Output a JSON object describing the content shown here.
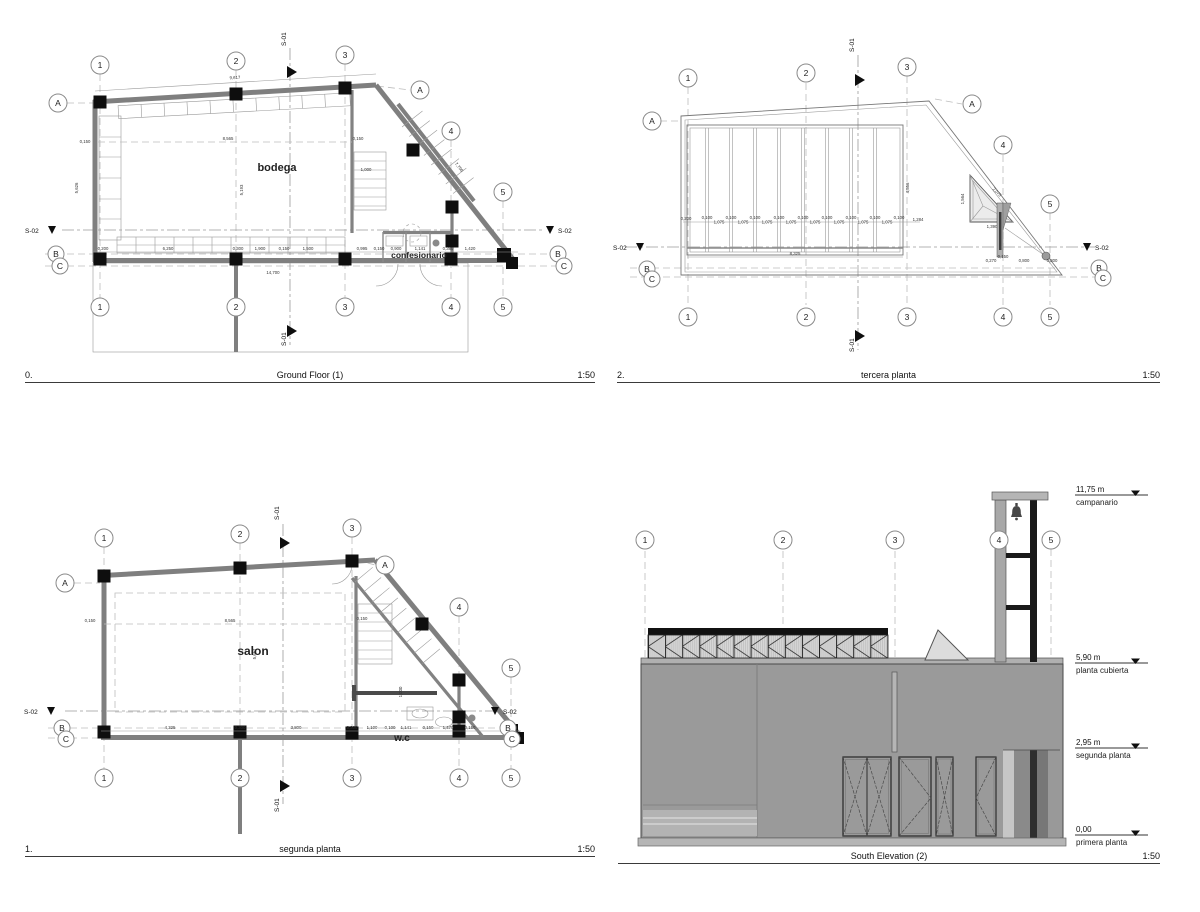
{
  "colors": {
    "wall": "#7f7f7f",
    "column": "#0e0e0e",
    "mass": "#9a9a9a",
    "mass_light": "#b5b5b5"
  },
  "panels": {
    "ground_floor": {
      "number": "0.",
      "title": "Ground Floor (1)",
      "scale": "1:50",
      "grid_cols": [
        "1",
        "2",
        "3",
        "4",
        "5"
      ],
      "grid_rows": {
        "a": "A",
        "b": "B",
        "c": "C"
      },
      "sections": {
        "s01": "S-01",
        "s02": "S-02"
      },
      "rooms": {
        "bodega": "bodega",
        "confesionario": "confesionario"
      },
      "dims": {
        "top_total": "9,617",
        "left_wall": "0,150",
        "left_height": "5,626",
        "mid_width": "8,565",
        "mid_height": "5,193",
        "mid_wall": "0,150",
        "diag": "7,796",
        "stair": "1,000",
        "bottom": [
          "0,200",
          "6,250",
          "0,300",
          "1,900",
          "0,150",
          "1,500",
          "0,995",
          "0,150",
          "0,900",
          "1,141",
          "0,380",
          "1,420"
        ],
        "bottom_total": "14,700"
      }
    },
    "tercera": {
      "number": "2.",
      "title": "tercera planta",
      "scale": "1:50",
      "grid_cols": [
        "1",
        "2",
        "3",
        "4",
        "5"
      ],
      "grid_rows": {
        "a": "A",
        "b": "B",
        "c": "C"
      },
      "sections": {
        "s01": "S-01",
        "s02": "S-02"
      },
      "dims": {
        "edge": "0,200",
        "joist": "0,100",
        "bay": "1,075",
        "right": "1,284",
        "total": "8,325",
        "height": "4,556",
        "tri_left": "1,564",
        "tri_hyp": "2,075",
        "tri_base": "1,390",
        "tower": [
          "0,270",
          "0,150",
          "0,800",
          "0,300"
        ]
      }
    },
    "segunda": {
      "number": "1.",
      "title": "segunda planta",
      "scale": "1:50",
      "grid_cols": [
        "1",
        "2",
        "3",
        "4",
        "5"
      ],
      "grid_rows": {
        "a": "A",
        "b": "B",
        "c": "C"
      },
      "sections": {
        "s01": "S-01",
        "s02": "S-02"
      },
      "rooms": {
        "salon": "salon",
        "wc": "w.c"
      },
      "dims": {
        "left_wall": "0,150",
        "mid_width": "8,565",
        "mid_wall": "0,150",
        "mid_height": "5,657",
        "stair": "1,000",
        "bottom": [
          "4,325",
          "0,300",
          "3,800",
          "0,300",
          "1,100",
          "0,100",
          "1,141",
          "0,150",
          "1,470",
          "0,150"
        ]
      }
    },
    "elevation": {
      "title": "South Elevation (2)",
      "scale": "1:50",
      "grid_cols": [
        "1",
        "2",
        "3",
        "4",
        "5"
      ],
      "levels": [
        {
          "height": "11,75 m",
          "label": "campanario"
        },
        {
          "height": "5,90 m",
          "label": "planta cubierta"
        },
        {
          "height": "2,95 m",
          "label": "segunda planta"
        },
        {
          "height": "0,00",
          "label": "primera planta"
        }
      ]
    }
  }
}
